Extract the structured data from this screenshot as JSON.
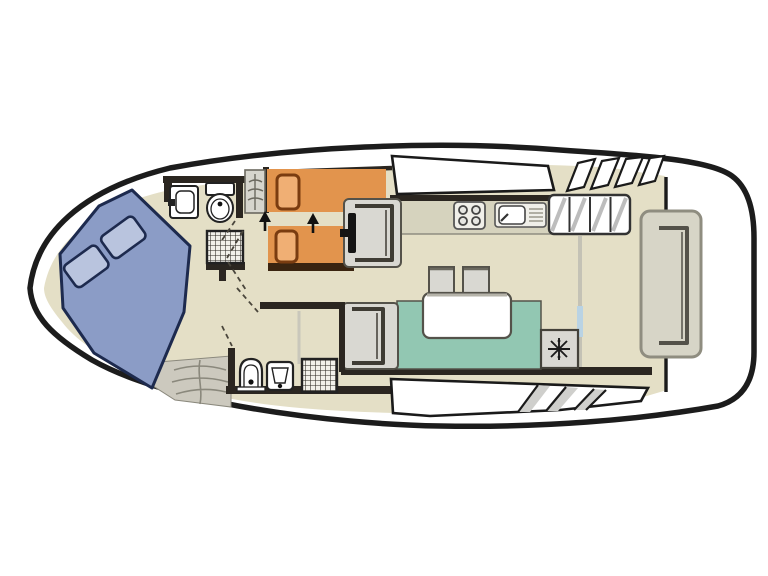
{
  "diagram": {
    "type": "boat-floor-plan",
    "view": "top-down deck plan",
    "regions": {
      "bow_cabin": "v-berth double bed with two pillows",
      "fore_bathroom": "sink, toilet, shower",
      "twin_cabin": "two single beds with pillows",
      "helm": "steering wheel and helm seat",
      "galley": "counter with 4-burner stove and sink",
      "saloon": "L-shaped dinette bench, table, two stools, fridge",
      "aft_bathroom": "toilet, sink, shower",
      "aft_deck": "stern bench seat"
    },
    "icons": {
      "toilet": "toilet-icon",
      "sink": "sink-icon",
      "shower": "shower-hatch-icon",
      "stove": "stove-burners-icon",
      "fridge": "snowflake-icon",
      "stairs": "companionway-steps-icon",
      "direction": "arrow-up-icon",
      "steering": "steering-wheel-icon"
    }
  },
  "colors": {
    "background": "#ffffff",
    "hull_stroke": "#1c1c1c",
    "hull_fill": "#ffffff",
    "floor": "#e4dfc6",
    "wall": "#2b2620",
    "vberth": "#8b9cc6",
    "vberth_stroke": "#1d2a4e",
    "vberth_pillow": "#b9c4de",
    "single_bed": "#e2944d",
    "single_bed_pillow": "#f0af74",
    "single_bed_pillow_stroke": "#7a3c10",
    "bed_shadow": "#3a2410",
    "dinette": "#92c7b2",
    "table": "#ffffff",
    "furniture": "#d9d8d2",
    "furniture_stroke": "#54524a",
    "bench_stern": "#d7d5c7",
    "counter": "#d6d3be",
    "window": "#ffffff",
    "window_stroke": "#1a1a1a",
    "steps": "#ccc9be",
    "door_glass": "#b9d3e4",
    "track_line": "#c4c2b5",
    "fixture": "#ffffff",
    "fixture_stroke": "#222222"
  }
}
